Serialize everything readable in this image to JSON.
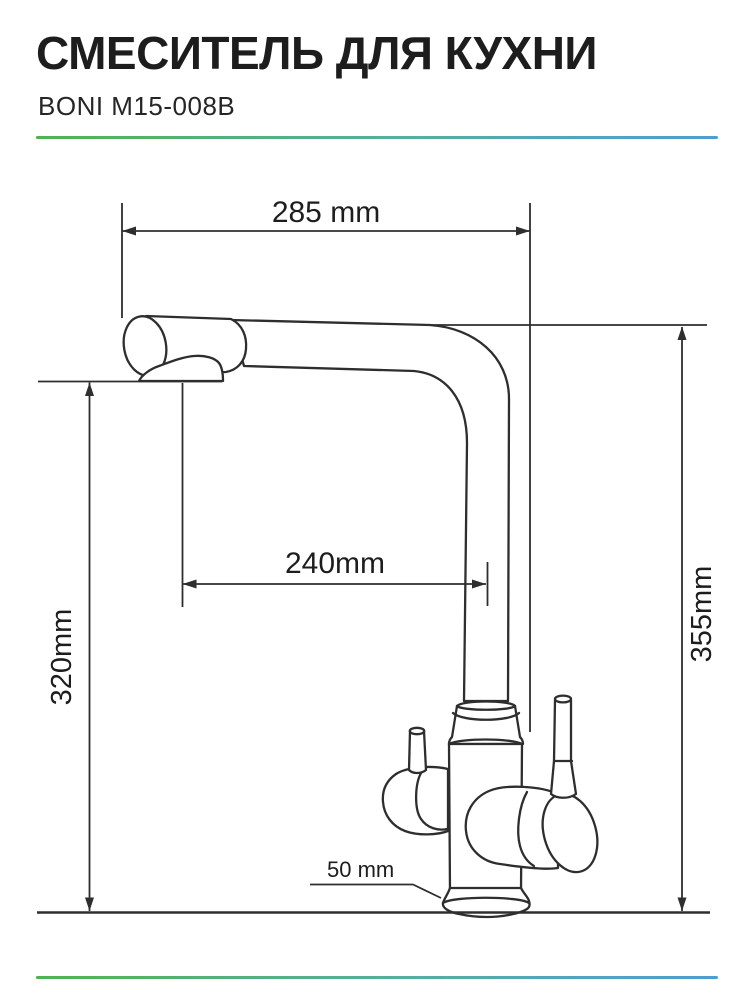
{
  "header": {
    "title": "СМЕСИТЕЛЬ ДЛЯ КУХНИ",
    "model": "BONI M15-008B"
  },
  "diagram": {
    "dim_top_width": "285 mm",
    "dim_spout_reach": "240mm",
    "dim_spout_height": "320mm",
    "dim_total_height": "355mm",
    "dim_base": "50 mm"
  },
  "colors": {
    "accent_green": "#4eb452",
    "accent_blue": "#4b9ed3",
    "drawing_line": "#2e2e2e",
    "text": "#1d1d1d"
  }
}
